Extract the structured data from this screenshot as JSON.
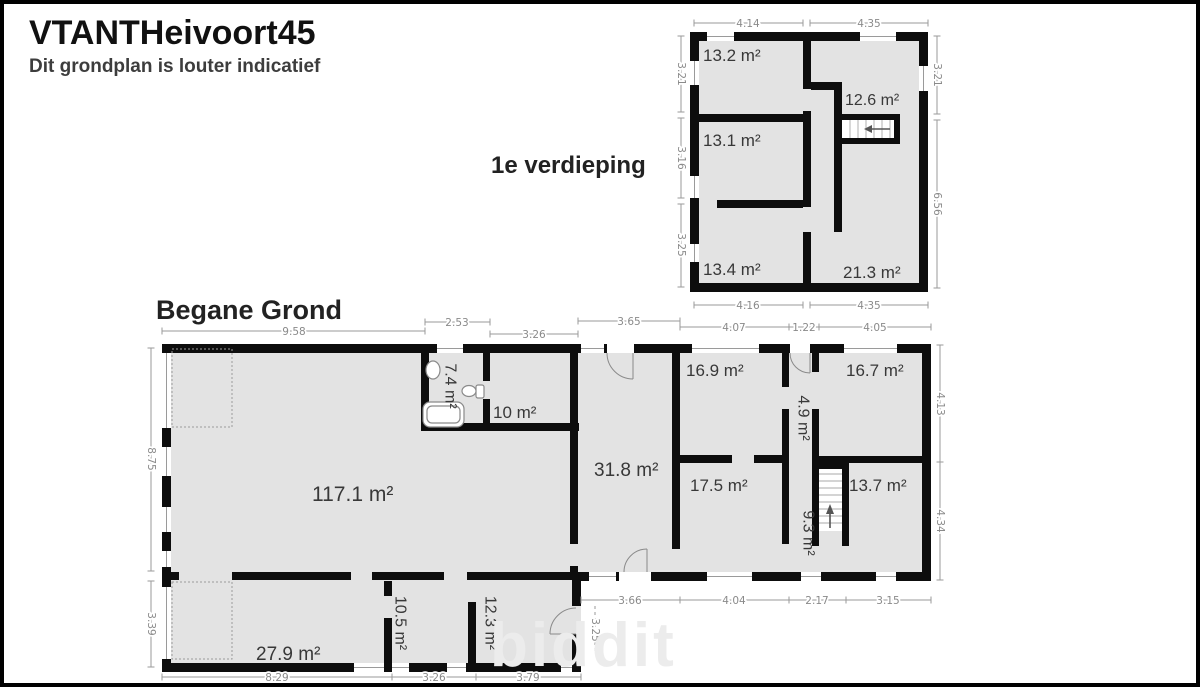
{
  "header": {
    "title": "VTANTHeivoort45",
    "subtitle": "Dit grondplan is louter indicatief"
  },
  "watermark": "biddit",
  "first_floor": {
    "title": "1e verdieping",
    "rooms": [
      "13.2 m²",
      "13.1 m²",
      "13.4 m²",
      "12.6 m²",
      "21.3 m²"
    ],
    "dims": {
      "top": [
        "4.14",
        "4.35"
      ],
      "bottom": [
        "4.16",
        "4.35"
      ],
      "left": [
        "3.21",
        "3.16",
        "3.25"
      ],
      "right": [
        "3.21",
        "6.56"
      ]
    }
  },
  "ground_floor": {
    "title": "Begane Grond",
    "rooms": [
      "117.1 m²",
      "7.4 m²",
      "10 m²",
      "31.8 m²",
      "16.9 m²",
      "16.7 m²",
      "4.9 m²",
      "17.5 m²",
      "9.3 m²",
      "13.7 m²",
      "27.9 m²",
      "10.5 m²",
      "12.3 m²"
    ],
    "dims": {
      "top": [
        "9.58",
        "2.53",
        "3.26",
        "3.65",
        "4.07",
        "1.22",
        "4.05"
      ],
      "left": [
        "8.75",
        "3.39"
      ],
      "right": [
        "4.13",
        "4.34"
      ],
      "bottom_left": [
        "8.29",
        "3.26",
        "3.79"
      ],
      "bottom_right": [
        "3.66",
        "4.04",
        "2.17",
        "3.15"
      ],
      "step": "3.25"
    }
  },
  "colors": {
    "wall": "#0d0d0d",
    "room_fill": "#e3e3e3",
    "dimension_text": "#8a8a8a",
    "label_text": "#383838"
  }
}
